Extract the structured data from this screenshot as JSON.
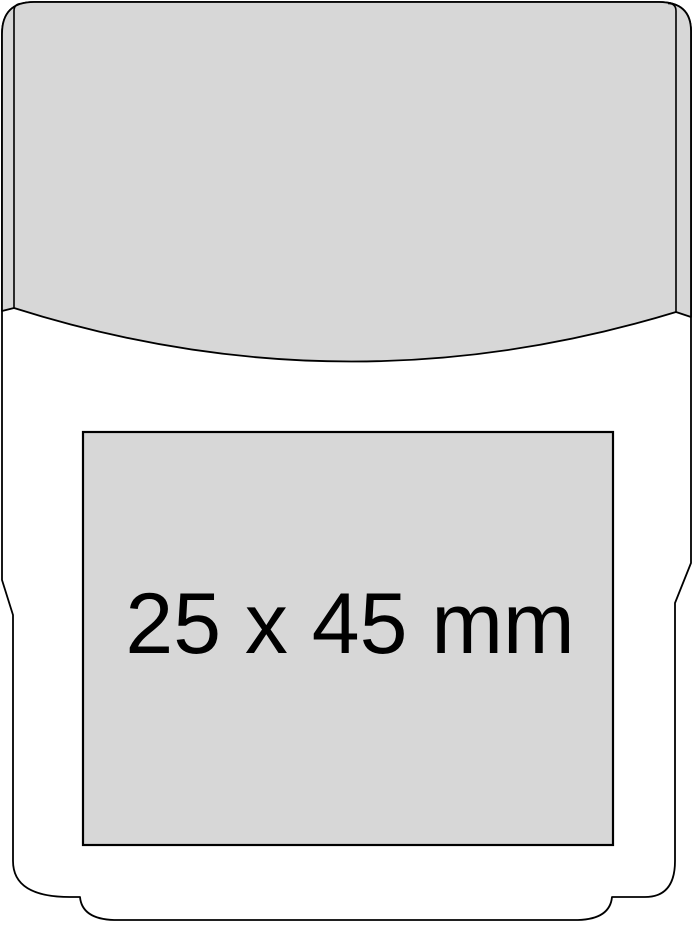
{
  "print_area": {
    "label": "25 x 45 mm"
  },
  "colors": {
    "panel_fill": "#d7d7d7",
    "outline": "#000000",
    "background": "#ffffff"
  }
}
